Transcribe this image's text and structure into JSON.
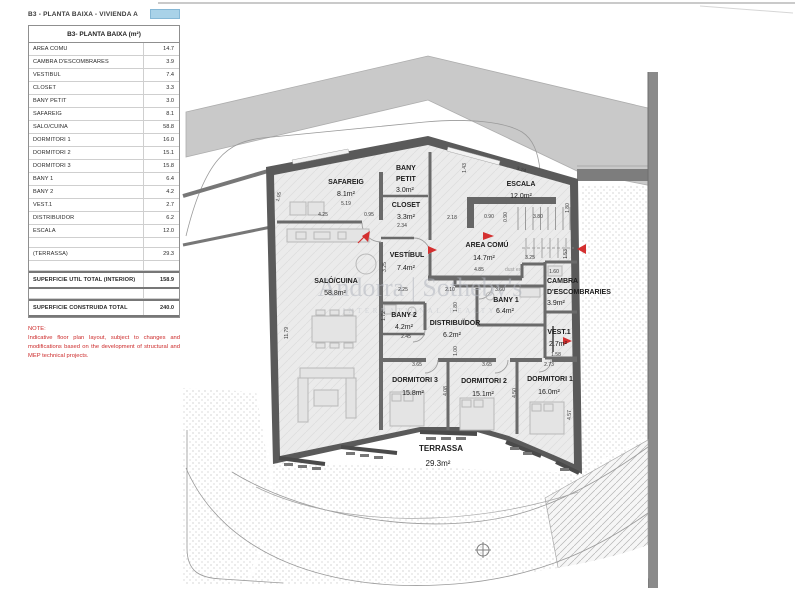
{
  "title": {
    "label": "B3 - PLANTA BAIXA - VIVIENDA A"
  },
  "colors": {
    "accent_blue": "#a9d2e8",
    "marker_red": "#d43030",
    "wall_gray": "#5a5a5a",
    "road_gray": "#c9c9c9"
  },
  "legend": {
    "header": "B3- PLANTA BAIXA (m²)",
    "rows": [
      {
        "label": "AREA COMÚ",
        "value": "14.7"
      },
      {
        "label": "CAMBRA D'ESCOMBRARES",
        "value": "3.9"
      },
      {
        "label": "VESTÍBUL",
        "value": "7.4"
      },
      {
        "label": "CLOSET",
        "value": "3.3"
      },
      {
        "label": "BANY PETIT",
        "value": "3.0"
      },
      {
        "label": "SAFAREIG",
        "value": "8.1"
      },
      {
        "label": "SALÓ/CUINA",
        "value": "58.8"
      },
      {
        "label": "DORMITORI 1",
        "value": "16.0"
      },
      {
        "label": "DORMITORI 2",
        "value": "15.1"
      },
      {
        "label": "DORMITORI 3",
        "value": "15.8"
      },
      {
        "label": "BANY 1",
        "value": "6.4"
      },
      {
        "label": "BANY 2",
        "value": "4.2"
      },
      {
        "label": "VEST.1",
        "value": "2.7"
      },
      {
        "label": "DISTRIBUIDOR",
        "value": "6.2"
      },
      {
        "label": "ESCALA",
        "value": "12.0"
      }
    ],
    "terrassa": {
      "label": "(TERRASSA)",
      "value": "29.3"
    },
    "total_util": {
      "label": "SUPERFICIE UTIL TOTAL (INTERIOR)",
      "value": "158.9"
    },
    "total_const": {
      "label": "SUPERFICIE CONSTRUIDA TOTAL",
      "value": "240.0"
    },
    "note_title": "NOTE:",
    "note_body": "Indicative floor plan layout, subject to changes and modifications based on the development of structural and MEP technical projects."
  },
  "watermark": {
    "line1": "Andorra | Sotheby's",
    "line2": "INTERNATIONAL REALTY"
  },
  "plan": {
    "rooms": {
      "safareig": {
        "name": "SAFAREIG",
        "area": "8.1m²"
      },
      "bany_petit": {
        "line1": "BANY",
        "line2": "PETIT",
        "area": "3.0m²"
      },
      "closet": {
        "name": "CLOSET",
        "area": "3.3m²"
      },
      "escala": {
        "name": "ESCALA",
        "area": "12.0m²"
      },
      "vestibul": {
        "name": "VESTÍBUL",
        "area": "7.4m²"
      },
      "area_comu": {
        "name": "AREA COMÚ",
        "area": "14.7m²"
      },
      "cambra": {
        "line1": "CAMBRA",
        "line2": "D'ESCOMBRARIES",
        "area": "3.9m²"
      },
      "salo": {
        "name": "SALÓ/CUINA",
        "area": "58.8m²"
      },
      "bany1": {
        "name": "BANY 1",
        "area": "6.4m²"
      },
      "bany2": {
        "name": "BANY 2",
        "area": "4.2m²"
      },
      "distribuidor": {
        "name": "DISTRIBUÏDOR",
        "area": "6.2m²"
      },
      "vest1": {
        "name": "VEST.1",
        "area": "2.7m²"
      },
      "dorm3": {
        "name": "DORMITORI 3",
        "area": "15.8m²"
      },
      "dorm2": {
        "name": "DORMITORI 2",
        "area": "15.1m²"
      },
      "dorm1": {
        "name": "DORMITORI 1",
        "area": "16.0m²"
      },
      "terrassa": {
        "name": "TERRASSA",
        "area": "29.3m²"
      }
    },
    "stair_note": "dust es",
    "dims": [
      "5.19",
      "4.25",
      "0.95",
      "2.34",
      "2.18",
      "0.90",
      "3.80",
      "1.43",
      "3.24",
      "1.80",
      "0.90",
      "4.85",
      "3.25",
      "1.53",
      "1.60",
      "3.25",
      "2.25",
      "2.10",
      "3.60",
      "1.72",
      "2.45",
      "1.80",
      "1.00",
      "1.58",
      "2.73",
      "3.65",
      "3.65",
      "4.08",
      "4.50",
      "4.57",
      "11.79",
      "1.05"
    ]
  }
}
